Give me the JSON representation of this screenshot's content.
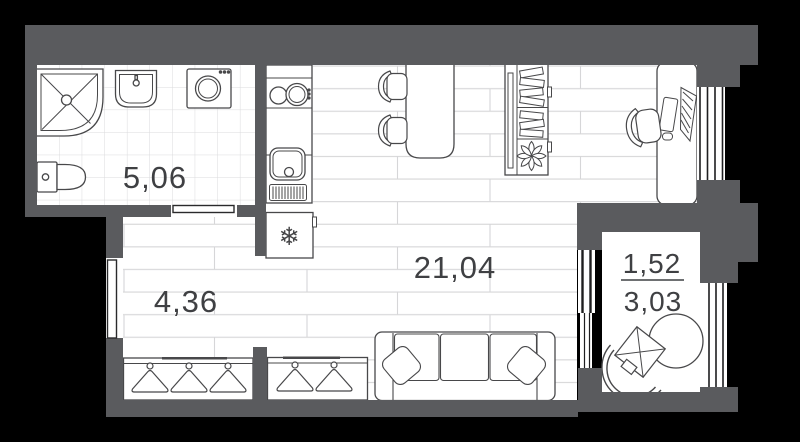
{
  "plan": {
    "title": "studio-apartment-floor-plan",
    "rooms": {
      "bathroom": {
        "area": "5,06"
      },
      "hallway": {
        "area": "4,36"
      },
      "living": {
        "area": "21,04"
      },
      "balcony": {
        "area_reduced": "1,52",
        "area_full": "3,03"
      }
    },
    "icons": {
      "snowflake-icon": "❄"
    },
    "furniture": [
      "shower",
      "washbasin",
      "washing-machine",
      "toilet",
      "stove",
      "kitchen-sink",
      "refrigerator",
      "dining-table",
      "dining-chairs",
      "tv-shelving-unit",
      "desk",
      "desk-chair",
      "office-monitor",
      "sofa",
      "pillows",
      "wardrobe-with-hangers",
      "balcony-table",
      "balcony-chair"
    ],
    "colors": {
      "background": "#000000",
      "wall": "#5a5b5e",
      "floor_line": "#d6d6d8",
      "outline": "#48484a",
      "window_line": "#1e1e20",
      "label": "#3f4043"
    }
  }
}
